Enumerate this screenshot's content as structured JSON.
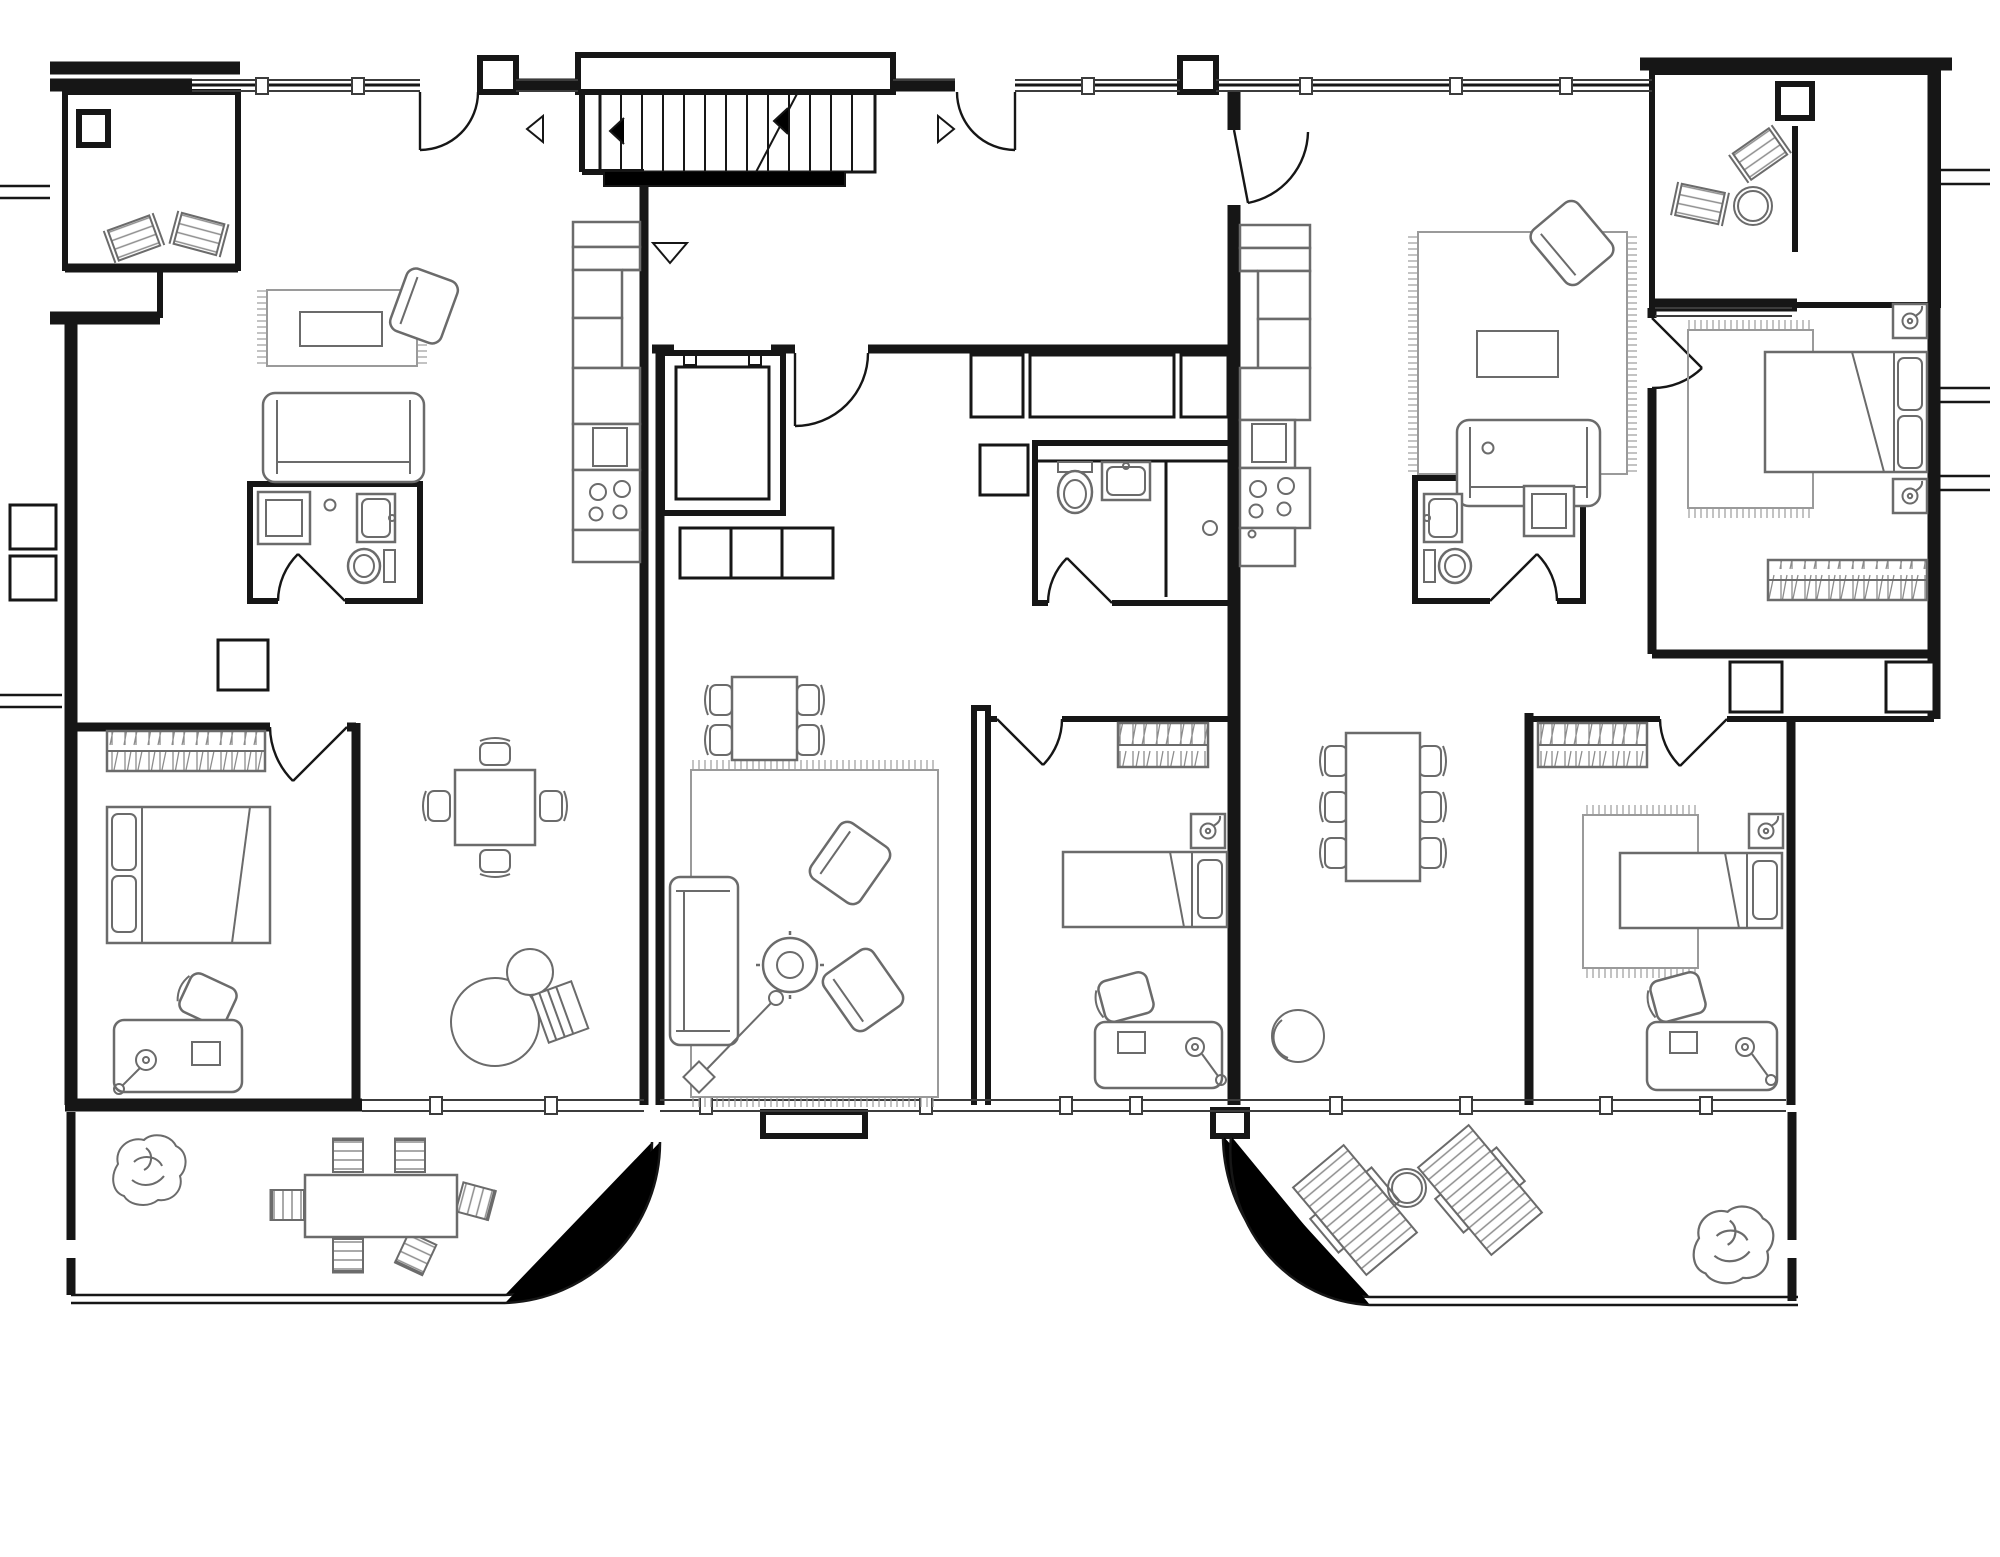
{
  "document": {
    "kind": "architectural-floor-plan",
    "view": "top-down plan, single storey of an apartment slab block",
    "composition": "three apartment units around a central stair-and-elevator core, two street-side balconies, two garden terraces with curved corners, neighbouring units cut off at left and right edges",
    "text_labels": "none visible in drawing"
  },
  "colors": {
    "background": "#ffffff",
    "walls": "#161616",
    "windows": "#3c3c3c",
    "furniture": "#6b6b6b",
    "furniture_light": "#9a9a9a"
  },
  "stair_core": {
    "elements": [
      "staircase with treads and up-direction diagonal",
      "stair landing",
      "left-direction-arrow",
      "right-direction-arrow",
      "down-entrance-arrow",
      "chevron marks",
      "elevator shaft with double wall",
      "three storage lockers",
      "entry doors with quarter-circle swings"
    ]
  },
  "units": [
    {
      "id": "unit-left",
      "rooms": [
        {
          "name": "balcony",
          "furniture": [
            "column",
            "deck-chair",
            "deck-chair"
          ]
        },
        {
          "name": "living-dining",
          "furniture": [
            "rug with fringe",
            "coffee-table",
            "armchair",
            "sofa",
            "square dining-table",
            "4 dining-chairs",
            "pouf",
            "ball side-table",
            "magazine-basket",
            "storage-cube"
          ]
        },
        {
          "name": "kitchen",
          "furniture": [
            "tall cabinets",
            "counter",
            "sink",
            "cooktop 4 burners"
          ]
        },
        {
          "name": "bathroom",
          "furniture": [
            "washing-machine",
            "ceiling-light",
            "wall sink",
            "toilet"
          ]
        },
        {
          "name": "bedroom",
          "furniture": [
            "wardrobe with hanging clothes",
            "double-bed with 2 pillows",
            "desk",
            "desk-chair",
            "desk-lamp",
            "laptop"
          ]
        },
        {
          "name": "terrace",
          "furniture": [
            "plant",
            "rectangular table",
            "6 outdoor chairs"
          ]
        }
      ]
    },
    {
      "id": "unit-center",
      "rooms": [
        {
          "name": "hall",
          "furniture": [
            "storage-cabinet row",
            "washing-machine"
          ]
        },
        {
          "name": "bathroom",
          "furniture": [
            "toilet",
            "wall sink",
            "shower with drain"
          ]
        },
        {
          "name": "living-dining",
          "furniture": [
            "square dining-table",
            "4 dining-chairs",
            "rug with fringe",
            "sofa",
            "2 armchairs",
            "round coffee-table",
            "floor-lamp"
          ]
        },
        {
          "name": "bedroom",
          "furniture": [
            "wardrobe with hanging clothes",
            "single-bed with pillow",
            "nightstand",
            "table-lamp",
            "desk",
            "desk-chair",
            "desk-lamp",
            "laptop"
          ]
        }
      ]
    },
    {
      "id": "unit-right",
      "rooms": [
        {
          "name": "balcony",
          "furniture": [
            "column",
            "privacy-divider",
            "deck-chair",
            "deck-chair",
            "round table"
          ]
        },
        {
          "name": "living-room",
          "furniture": [
            "rug with fringe",
            "coffee-table",
            "armchair",
            "sofa"
          ]
        },
        {
          "name": "kitchen",
          "furniture": [
            "tall cabinets",
            "counter",
            "sink",
            "cooktop 4 burners"
          ]
        },
        {
          "name": "bathroom",
          "furniture": [
            "washing-machine",
            "ceiling-light",
            "wall sink",
            "toilet",
            "floor-drain"
          ]
        },
        {
          "name": "master-bedroom",
          "furniture": [
            "double-bed with 2 pillows",
            "rug with fringe",
            "2 nightstands with lamps",
            "wardrobe with hanging clothes"
          ]
        },
        {
          "name": "dining-area",
          "furniture": [
            "rectangular dining-table",
            "6 dining-chairs",
            "pouf"
          ]
        },
        {
          "name": "bedroom-2",
          "furniture": [
            "wardrobe with hanging clothes",
            "rug with fringe",
            "single-bed with pillow",
            "nightstand",
            "table-lamp",
            "desk",
            "desk-chair",
            "desk-lamp",
            "laptop"
          ]
        },
        {
          "name": "terrace",
          "furniture": [
            "2 sun-loungers",
            "round side-table",
            "plant"
          ]
        }
      ]
    }
  ]
}
